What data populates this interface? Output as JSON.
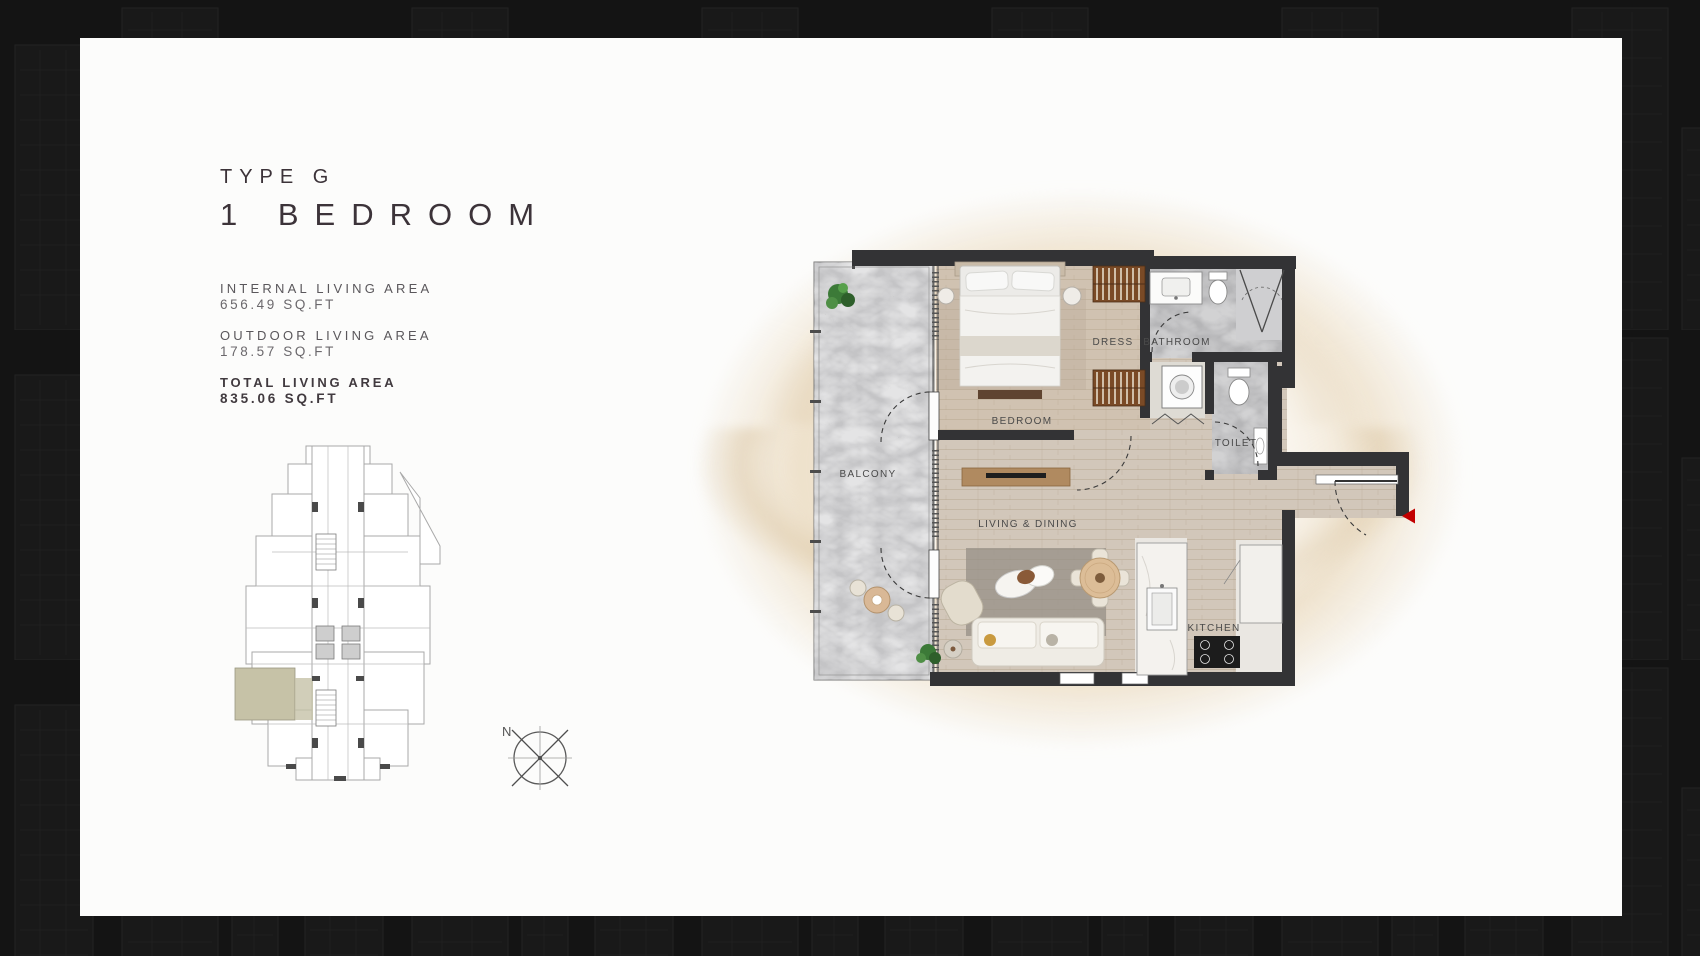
{
  "card": {
    "type_label": "TYPE G",
    "title": "1  BEDROOM",
    "areas": [
      {
        "label": "INTERNAL LIVING AREA",
        "value": "656.49 SQ.FT"
      },
      {
        "label": "OUTDOOR LIVING AREA",
        "value": "178.57 SQ.FT"
      },
      {
        "label": "TOTAL LIVING AREA",
        "value": "835.06 SQ.FT"
      }
    ],
    "compass": {
      "north_label": "N"
    }
  },
  "floorplan": {
    "rooms": [
      {
        "name": "BALCONY"
      },
      {
        "name": "BEDROOM"
      },
      {
        "name": "DRESS"
      },
      {
        "name": "BATHROOM"
      },
      {
        "name": "TOILET"
      },
      {
        "name": "LIVING & DINING"
      },
      {
        "name": "KITCHEN"
      }
    ]
  },
  "entry": {
    "marker_color": "#c20000"
  },
  "keyplan": {
    "highlight_color": "#c6c2a7"
  },
  "colors": {
    "wall": "#333335",
    "card_background": "#fcfcfb",
    "page_background": "#131313"
  }
}
